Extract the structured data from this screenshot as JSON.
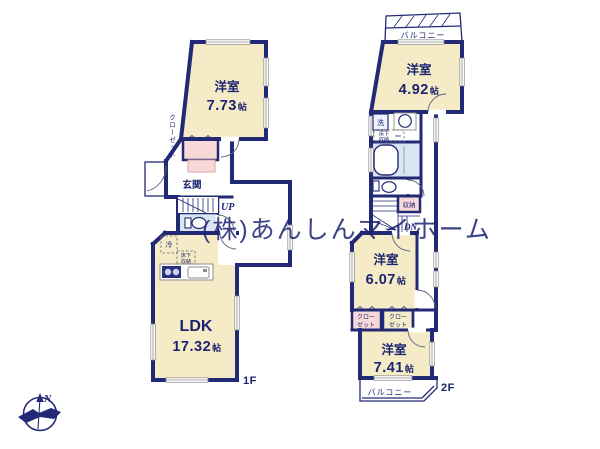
{
  "watermark": "(株)あんしんマイホーム",
  "compass": {
    "north_label": "N"
  },
  "floor1": {
    "label": "1F",
    "bedroom": {
      "name": "洋室",
      "size_value": "7.73",
      "size_unit": "帖"
    },
    "ldk": {
      "name": "LDK",
      "size_value": "17.32",
      "size_unit": "帖"
    },
    "entrance_label": "玄関",
    "closet_label": "クローゼット",
    "stairs_label": "UP",
    "fridge_label": "冷",
    "floor_storage_line1": "床下",
    "floor_storage_line2": "収納"
  },
  "floor2": {
    "label": "2F",
    "balcony_top_label": "バルコニー",
    "balcony_bottom_label": "バルコニー",
    "bedroom_small": {
      "name": "洋室",
      "size_value": "4.92",
      "size_unit": "帖"
    },
    "bedroom_mid": {
      "name": "洋室",
      "size_value": "6.07",
      "size_unit": "帖"
    },
    "bedroom_large": {
      "name": "洋室",
      "size_value": "7.41",
      "size_unit": "帖"
    },
    "washer_label": "洗",
    "floor_storage_line1": "床下",
    "floor_storage_line2": "収納",
    "storage_label": "収納",
    "stairs_label": "DN",
    "closet_left_line1": "クロー",
    "closet_left_line2": "ゼット",
    "closet_right_line1": "クロー",
    "closet_right_line2": "ゼット"
  },
  "colors": {
    "wall": "#232a75",
    "room_fill": "#f5ebc6",
    "closet_fill": "#f7d9d8",
    "bath_fill": "#dbe6f4",
    "watermark": "#c7c7c7",
    "label_text": "#1b2370"
  }
}
